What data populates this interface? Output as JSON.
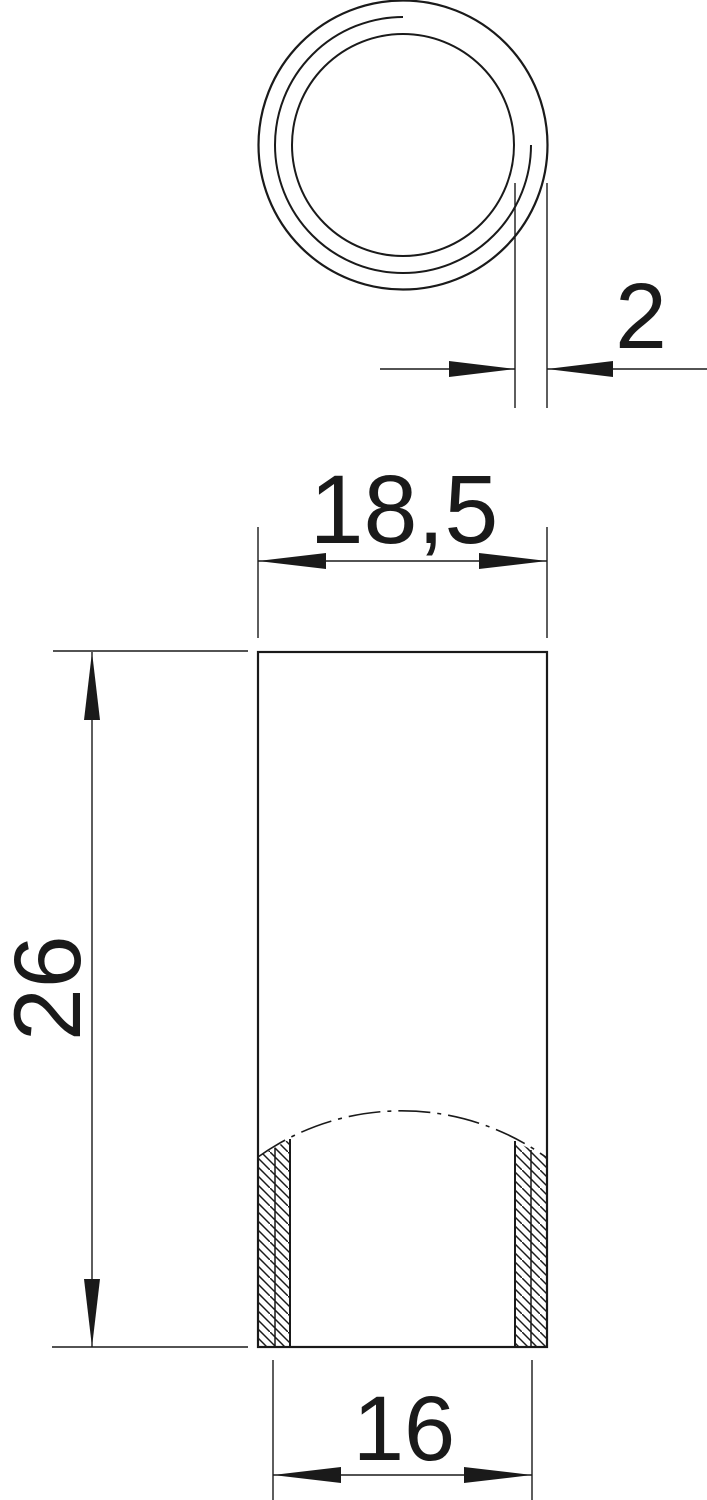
{
  "drawing": {
    "background_color": "#ffffff",
    "line_color": "#1a1a1a",
    "views": [
      {
        "id": "top-view",
        "label": "pipe cross-section with outer circle, partial thread circle and bore circle"
      },
      {
        "id": "front-view",
        "label": "pipe elevation with sectioned internal thread at bottom"
      }
    ],
    "dimensions": [
      {
        "id": "wall-thickness",
        "value": "2"
      },
      {
        "id": "outer-width",
        "value": "18,5"
      },
      {
        "id": "overall-length",
        "value": "26"
      },
      {
        "id": "thread-diameter",
        "value": "16"
      }
    ]
  }
}
